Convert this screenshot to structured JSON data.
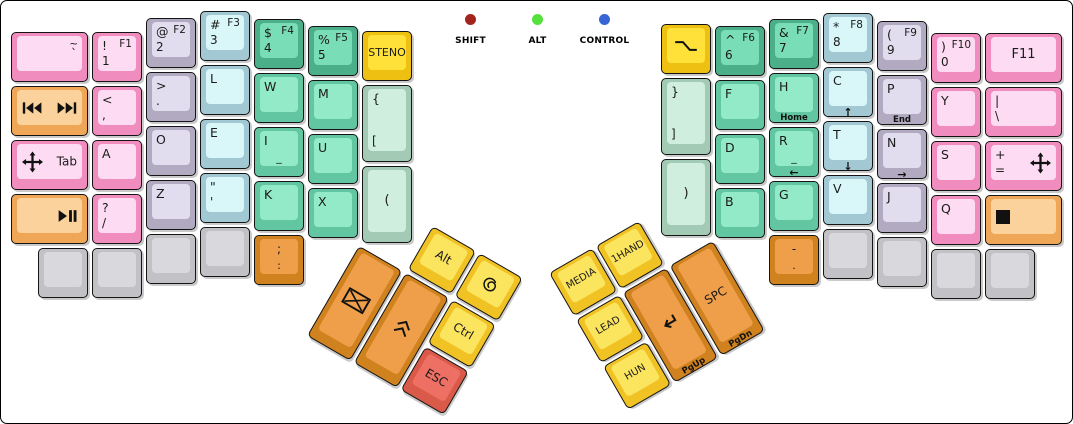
{
  "indicators": {
    "items": [
      {
        "label": "SHIFT",
        "color": "#a3241d"
      },
      {
        "label": "ALT",
        "color": "#55e13c"
      },
      {
        "label": "CONTROL",
        "color": "#3765d6"
      }
    ]
  },
  "palette": {
    "pink": {
      "side": "#f08cbe",
      "top": "#fddcf3"
    },
    "lavender": {
      "side": "#b1aac0",
      "top": "#e2ddee"
    },
    "cyan": {
      "side": "#a2c9d3",
      "top": "#d9f6f9"
    },
    "teal": {
      "side": "#4bb08a",
      "top": "#79ddb8"
    },
    "mint": {
      "side": "#63c6a2",
      "top": "#93eac8"
    },
    "pale": {
      "side": "#a2cab4",
      "top": "#cfeede"
    },
    "grey": {
      "side": "#c2c2c6",
      "top": "#d9d9dd"
    },
    "yellow": {
      "side": "#edc011",
      "top": "#ffe13a"
    },
    "lemon": {
      "side": "#f0c224",
      "top": "#fbe45e"
    },
    "apricot": {
      "side": "#efa657",
      "top": "#fcd29c"
    },
    "orange": {
      "side": "#d0821f",
      "top": "#ef9f49"
    },
    "red": {
      "side": "#d95a49",
      "top": "#ee6f64"
    }
  },
  "groups": [
    {
      "name": "left-main-block",
      "x": 10,
      "y": 10,
      "rot": 0,
      "keys": [
        {
          "n": "key-grave-tilde",
          "x": 0,
          "y": 21,
          "w": 77,
          "h": 50,
          "c": "pink",
          "legends": {
            "tr": "~",
            "mr": "`"
          }
        },
        {
          "n": "key-1-f1",
          "x": 81,
          "y": 21,
          "w": 50,
          "h": 50,
          "c": "pink",
          "legends": {
            "tl": "!",
            "tr": "F1",
            "bl": "1"
          }
        },
        {
          "n": "key-2-f2",
          "x": 135,
          "y": 7,
          "w": 50,
          "h": 50,
          "c": "lavender",
          "legends": {
            "tl": "@",
            "tr": "F2",
            "bl": "2"
          }
        },
        {
          "n": "key-3-f3",
          "x": 189,
          "y": 0,
          "w": 50,
          "h": 50,
          "c": "cyan",
          "legends": {
            "tl": "#",
            "tr": "F3",
            "bl": "3"
          }
        },
        {
          "n": "key-4-f4",
          "x": 243,
          "y": 8,
          "w": 50,
          "h": 50,
          "c": "teal",
          "legends": {
            "tl": "$",
            "tr": "F4",
            "bl": "4"
          }
        },
        {
          "n": "key-5-f5",
          "x": 297,
          "y": 15,
          "w": 50,
          "h": 50,
          "c": "teal",
          "legends": {
            "tl": "%",
            "tr": "F5",
            "bl": "5"
          }
        },
        {
          "n": "key-steno",
          "x": 351,
          "y": 20,
          "w": 50,
          "h": 50,
          "c": "yellow",
          "fs": 11,
          "legends": {
            "ctr": "STENO"
          }
        },
        {
          "n": "key-media-prev-next",
          "x": 0,
          "y": 75,
          "w": 77,
          "h": 50,
          "c": "apricot",
          "legends": {
            "ml": "icon:prev-track",
            "mr": "icon:next-track"
          }
        },
        {
          "n": "key-comma",
          "x": 81,
          "y": 75,
          "w": 50,
          "h": 50,
          "c": "pink",
          "legends": {
            "tl": "<",
            "bl": ","
          }
        },
        {
          "n": "key-period",
          "x": 135,
          "y": 61,
          "w": 50,
          "h": 50,
          "c": "lavender",
          "legends": {
            "tl": ">",
            "bl": "."
          }
        },
        {
          "n": "key-l",
          "x": 189,
          "y": 54,
          "w": 50,
          "h": 50,
          "c": "cyan",
          "legends": {
            "tl": "L"
          }
        },
        {
          "n": "key-w",
          "x": 243,
          "y": 62,
          "w": 50,
          "h": 50,
          "c": "mint",
          "legends": {
            "tl": "W"
          }
        },
        {
          "n": "key-m",
          "x": 297,
          "y": 69,
          "w": 50,
          "h": 50,
          "c": "mint",
          "legends": {
            "tl": "M"
          }
        },
        {
          "n": "key-lbrace-lbracket",
          "x": 351,
          "y": 74,
          "w": 50,
          "h": 77,
          "c": "pale",
          "legends": {
            "tl": "{",
            "bl": "["
          }
        },
        {
          "n": "key-tab-move",
          "x": 0,
          "y": 129,
          "w": 77,
          "h": 50,
          "c": "pink",
          "legends": {
            "ml": "icon:move",
            "mr": "Tab"
          }
        },
        {
          "n": "key-a",
          "x": 81,
          "y": 129,
          "w": 50,
          "h": 50,
          "c": "pink",
          "legends": {
            "tl": "A"
          }
        },
        {
          "n": "key-o",
          "x": 135,
          "y": 115,
          "w": 50,
          "h": 50,
          "c": "lavender",
          "legends": {
            "tl": "O"
          }
        },
        {
          "n": "key-e",
          "x": 189,
          "y": 108,
          "w": 50,
          "h": 50,
          "c": "cyan",
          "legends": {
            "tl": "E"
          }
        },
        {
          "n": "key-i",
          "x": 243,
          "y": 116,
          "w": 50,
          "h": 50,
          "c": "mint",
          "legends": {
            "tl": "I",
            "bc": "_"
          }
        },
        {
          "n": "key-u",
          "x": 297,
          "y": 123,
          "w": 50,
          "h": 50,
          "c": "mint",
          "legends": {
            "tl": "U"
          }
        },
        {
          "n": "key-lparen",
          "x": 351,
          "y": 155,
          "w": 50,
          "h": 77,
          "c": "pale",
          "fs": 13,
          "legends": {
            "ctr": "("
          }
        },
        {
          "n": "key-play-pause",
          "x": 0,
          "y": 183,
          "w": 77,
          "h": 50,
          "c": "apricot",
          "legends": {
            "mr": "icon:play-pause"
          }
        },
        {
          "n": "key-question-slash",
          "x": 81,
          "y": 183,
          "w": 50,
          "h": 50,
          "c": "pink",
          "legends": {
            "tl": "?",
            "bl": "/"
          }
        },
        {
          "n": "key-z",
          "x": 135,
          "y": 169,
          "w": 50,
          "h": 50,
          "c": "lavender",
          "legends": {
            "tl": "Z"
          }
        },
        {
          "n": "key-quote",
          "x": 189,
          "y": 162,
          "w": 50,
          "h": 50,
          "c": "cyan",
          "legends": {
            "tl": "\"",
            "bl": "'"
          }
        },
        {
          "n": "key-k",
          "x": 243,
          "y": 170,
          "w": 50,
          "h": 50,
          "c": "mint",
          "legends": {
            "tl": "K"
          }
        },
        {
          "n": "key-x",
          "x": 297,
          "y": 177,
          "w": 50,
          "h": 50,
          "c": "mint",
          "legends": {
            "tl": "X"
          }
        },
        {
          "n": "key-blank-l1",
          "x": 27,
          "y": 237,
          "w": 50,
          "h": 50,
          "c": "grey",
          "legends": {}
        },
        {
          "n": "key-blank-l2",
          "x": 81,
          "y": 237,
          "w": 50,
          "h": 50,
          "c": "grey",
          "legends": {}
        },
        {
          "n": "key-blank-l3",
          "x": 135,
          "y": 223,
          "w": 50,
          "h": 50,
          "c": "grey",
          "legends": {}
        },
        {
          "n": "key-blank-l4",
          "x": 189,
          "y": 216,
          "w": 50,
          "h": 50,
          "c": "grey",
          "legends": {}
        },
        {
          "n": "key-semicolon-colon",
          "x": 243,
          "y": 224,
          "w": 50,
          "h": 50,
          "c": "orange",
          "legends": {
            "tc": ";",
            "bc": ":"
          }
        }
      ]
    },
    {
      "name": "right-main-block",
      "x": 660,
      "y": 12,
      "rot": 0,
      "keys": [
        {
          "n": "key-option",
          "x": 0,
          "y": 11,
          "w": 50,
          "h": 50,
          "c": "yellow",
          "legends": {
            "ctr": "icon:option"
          }
        },
        {
          "n": "key-6-f6",
          "x": 54,
          "y": 13,
          "w": 50,
          "h": 50,
          "c": "teal",
          "legends": {
            "tl": "^",
            "tr": "F6",
            "bl": "6"
          }
        },
        {
          "n": "key-7-f7",
          "x": 108,
          "y": 6,
          "w": 50,
          "h": 50,
          "c": "teal",
          "legends": {
            "tl": "&",
            "tr": "F7",
            "bl": "7"
          }
        },
        {
          "n": "key-8-f8",
          "x": 162,
          "y": 0,
          "w": 50,
          "h": 50,
          "c": "cyan",
          "legends": {
            "tl": "*",
            "tr": "F8",
            "bl": "8"
          }
        },
        {
          "n": "key-9-f9",
          "x": 216,
          "y": 8,
          "w": 50,
          "h": 50,
          "c": "lavender",
          "legends": {
            "tl": "(",
            "tr": "F9",
            "bl": "9"
          }
        },
        {
          "n": "key-0-f10",
          "x": 270,
          "y": 20,
          "w": 50,
          "h": 50,
          "c": "pink",
          "legends": {
            "tl": ")",
            "tr": "F10",
            "bl": "0"
          }
        },
        {
          "n": "key-f11",
          "x": 324,
          "y": 20,
          "w": 77,
          "h": 50,
          "c": "pink",
          "fs": 13,
          "legends": {
            "ctr": "F11"
          }
        },
        {
          "n": "key-rbrace-rbracket",
          "x": 0,
          "y": 65,
          "w": 50,
          "h": 77,
          "c": "pale",
          "legends": {
            "tl": "}",
            "bl": "]"
          }
        },
        {
          "n": "key-f",
          "x": 54,
          "y": 67,
          "w": 50,
          "h": 50,
          "c": "mint",
          "legends": {
            "tl": "F"
          }
        },
        {
          "n": "key-h-home",
          "x": 108,
          "y": 60,
          "w": 50,
          "h": 50,
          "c": "mint",
          "legends": {
            "tl": "H",
            "front": "Home"
          }
        },
        {
          "n": "key-c-up",
          "x": 162,
          "y": 54,
          "w": 50,
          "h": 50,
          "c": "cyan",
          "legends": {
            "tl": "C",
            "front": "↑"
          }
        },
        {
          "n": "key-p-end",
          "x": 216,
          "y": 62,
          "w": 50,
          "h": 50,
          "c": "lavender",
          "legends": {
            "tl": "P",
            "front": "End"
          }
        },
        {
          "n": "key-y",
          "x": 270,
          "y": 74,
          "w": 50,
          "h": 50,
          "c": "pink",
          "legends": {
            "tl": "Y"
          }
        },
        {
          "n": "key-pipe-backslash",
          "x": 324,
          "y": 74,
          "w": 77,
          "h": 50,
          "c": "pink",
          "legends": {
            "tl": "|",
            "bl": "\\"
          }
        },
        {
          "n": "key-rparen",
          "x": 0,
          "y": 146,
          "w": 50,
          "h": 77,
          "c": "pale",
          "fs": 13,
          "legends": {
            "ctr": ")"
          }
        },
        {
          "n": "key-d",
          "x": 54,
          "y": 121,
          "w": 50,
          "h": 50,
          "c": "mint",
          "legends": {
            "tl": "D"
          }
        },
        {
          "n": "key-r-left",
          "x": 108,
          "y": 114,
          "w": 50,
          "h": 50,
          "c": "mint",
          "legends": {
            "tl": "R",
            "bc": "_",
            "front": "←"
          }
        },
        {
          "n": "key-t-down",
          "x": 162,
          "y": 108,
          "w": 50,
          "h": 50,
          "c": "cyan",
          "legends": {
            "tl": "T",
            "front": "↓"
          }
        },
        {
          "n": "key-n-right",
          "x": 216,
          "y": 116,
          "w": 50,
          "h": 50,
          "c": "lavender",
          "legends": {
            "tl": "N",
            "front": "→"
          }
        },
        {
          "n": "key-s",
          "x": 270,
          "y": 128,
          "w": 50,
          "h": 50,
          "c": "pink",
          "legends": {
            "tl": "S"
          }
        },
        {
          "n": "key-plus-equals-move",
          "x": 324,
          "y": 128,
          "w": 77,
          "h": 50,
          "c": "pink",
          "legends": {
            "tl": "+",
            "bl": "=",
            "mr": "icon:move"
          }
        },
        {
          "n": "key-b",
          "x": 54,
          "y": 175,
          "w": 50,
          "h": 50,
          "c": "mint",
          "legends": {
            "tl": "B"
          }
        },
        {
          "n": "key-g",
          "x": 108,
          "y": 168,
          "w": 50,
          "h": 50,
          "c": "mint",
          "legends": {
            "tl": "G"
          }
        },
        {
          "n": "key-v",
          "x": 162,
          "y": 162,
          "w": 50,
          "h": 50,
          "c": "cyan",
          "legends": {
            "tl": "V"
          }
        },
        {
          "n": "key-j",
          "x": 216,
          "y": 170,
          "w": 50,
          "h": 50,
          "c": "lavender",
          "legends": {
            "tl": "J"
          }
        },
        {
          "n": "key-q",
          "x": 270,
          "y": 182,
          "w": 50,
          "h": 50,
          "c": "pink",
          "legends": {
            "tl": "Q"
          }
        },
        {
          "n": "key-stop",
          "x": 324,
          "y": 182,
          "w": 77,
          "h": 50,
          "c": "apricot",
          "legends": {
            "ml": "icon:stop"
          }
        },
        {
          "n": "key-dash-period",
          "x": 108,
          "y": 222,
          "w": 50,
          "h": 50,
          "c": "orange",
          "legends": {
            "tc": "-",
            "bc": "."
          }
        },
        {
          "n": "key-blank-r1",
          "x": 162,
          "y": 216,
          "w": 50,
          "h": 50,
          "c": "grey",
          "legends": {}
        },
        {
          "n": "key-blank-r2",
          "x": 216,
          "y": 224,
          "w": 50,
          "h": 50,
          "c": "grey",
          "legends": {}
        },
        {
          "n": "key-blank-r3",
          "x": 270,
          "y": 236,
          "w": 50,
          "h": 50,
          "c": "grey",
          "legends": {}
        },
        {
          "n": "key-blank-r4",
          "x": 324,
          "y": 236,
          "w": 50,
          "h": 50,
          "c": "grey",
          "legends": {}
        }
      ]
    },
    {
      "name": "left-thumb-cluster",
      "x": 385,
      "y": 198,
      "rot": 30,
      "keys": [
        {
          "n": "key-alt",
          "x": 54,
          "y": 0,
          "w": 50,
          "h": 50,
          "c": "lemon",
          "legends": {
            "ctr": "Alt"
          }
        },
        {
          "n": "key-swirl",
          "x": 108,
          "y": 0,
          "w": 50,
          "h": 50,
          "c": "lemon",
          "legends": {
            "ctr": "icon:swirl"
          }
        },
        {
          "n": "key-mail",
          "x": 0,
          "y": 54,
          "w": 50,
          "h": 104,
          "c": "orange",
          "legends": {
            "ctr": "icon:envelope"
          }
        },
        {
          "n": "key-shift-chevrons",
          "x": 54,
          "y": 54,
          "w": 50,
          "h": 104,
          "c": "orange",
          "legends": {
            "ctr": "icon:chevrons-up"
          }
        },
        {
          "n": "key-ctrl",
          "x": 108,
          "y": 54,
          "w": 50,
          "h": 50,
          "c": "lemon",
          "legends": {
            "ctr": "Ctrl"
          }
        },
        {
          "n": "key-esc",
          "x": 108,
          "y": 108,
          "w": 50,
          "h": 50,
          "c": "red",
          "legends": {
            "ctr": "ESC"
          }
        }
      ]
    },
    {
      "name": "right-thumb-cluster",
      "x": 548,
      "y": 272,
      "rot": -30,
      "keys": [
        {
          "n": "key-media-layer",
          "x": 0,
          "y": 0,
          "w": 50,
          "h": 50,
          "c": "lemon",
          "fs": 10,
          "legends": {
            "ctr": "MEDIA"
          }
        },
        {
          "n": "key-1hand",
          "x": 54,
          "y": 0,
          "w": 50,
          "h": 50,
          "c": "lemon",
          "fs": 10,
          "legends": {
            "ctr": "1HAND"
          }
        },
        {
          "n": "key-lead",
          "x": 0,
          "y": 54,
          "w": 50,
          "h": 50,
          "c": "lemon",
          "fs": 10,
          "legends": {
            "ctr": "LEAD"
          }
        },
        {
          "n": "key-hun",
          "x": 0,
          "y": 108,
          "w": 50,
          "h": 50,
          "c": "lemon",
          "fs": 10,
          "legends": {
            "ctr": "HUN"
          }
        },
        {
          "n": "key-enter-pgup",
          "x": 54,
          "y": 54,
          "w": 50,
          "h": 104,
          "c": "orange",
          "legends": {
            "ctr": "icon:enter",
            "front": "PgUp"
          }
        },
        {
          "n": "key-spc-pgdn",
          "x": 108,
          "y": 54,
          "w": 50,
          "h": 104,
          "c": "orange",
          "fs": 12,
          "legends": {
            "ctr": "SPC",
            "front": "PgDn"
          }
        }
      ]
    }
  ]
}
